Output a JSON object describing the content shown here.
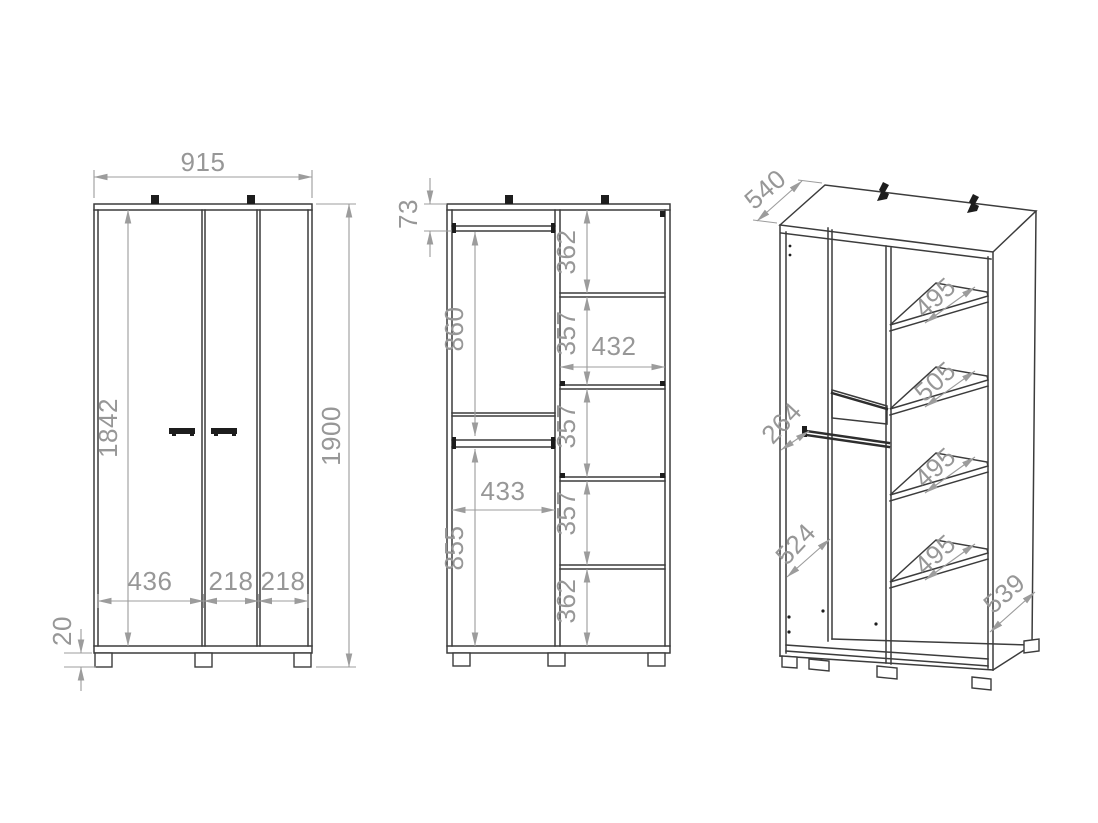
{
  "drawing": {
    "front_view": {
      "width": "915",
      "door_height": "1842",
      "total_height": "1900",
      "door_widths": [
        "436",
        "218",
        "218"
      ],
      "plinth_height": "20"
    },
    "interior_view": {
      "rail_top_offset": "73",
      "upper_section_height": "860",
      "left_compartment_width": "433",
      "lower_section_height": "855",
      "right_compartment_heights": [
        "362",
        "357",
        "357",
        "357",
        "362"
      ],
      "right_compartment_width": "432"
    },
    "perspective_view": {
      "depth": "540",
      "rail_inset": "264",
      "lower_compartment_depth": "524",
      "shelf_depths": [
        "495",
        "505",
        "495",
        "495"
      ],
      "base_depth": "539"
    },
    "colors": {
      "outline": "#3c3c3c",
      "dimension": "#9a9a9a",
      "background": "#ffffff"
    }
  }
}
